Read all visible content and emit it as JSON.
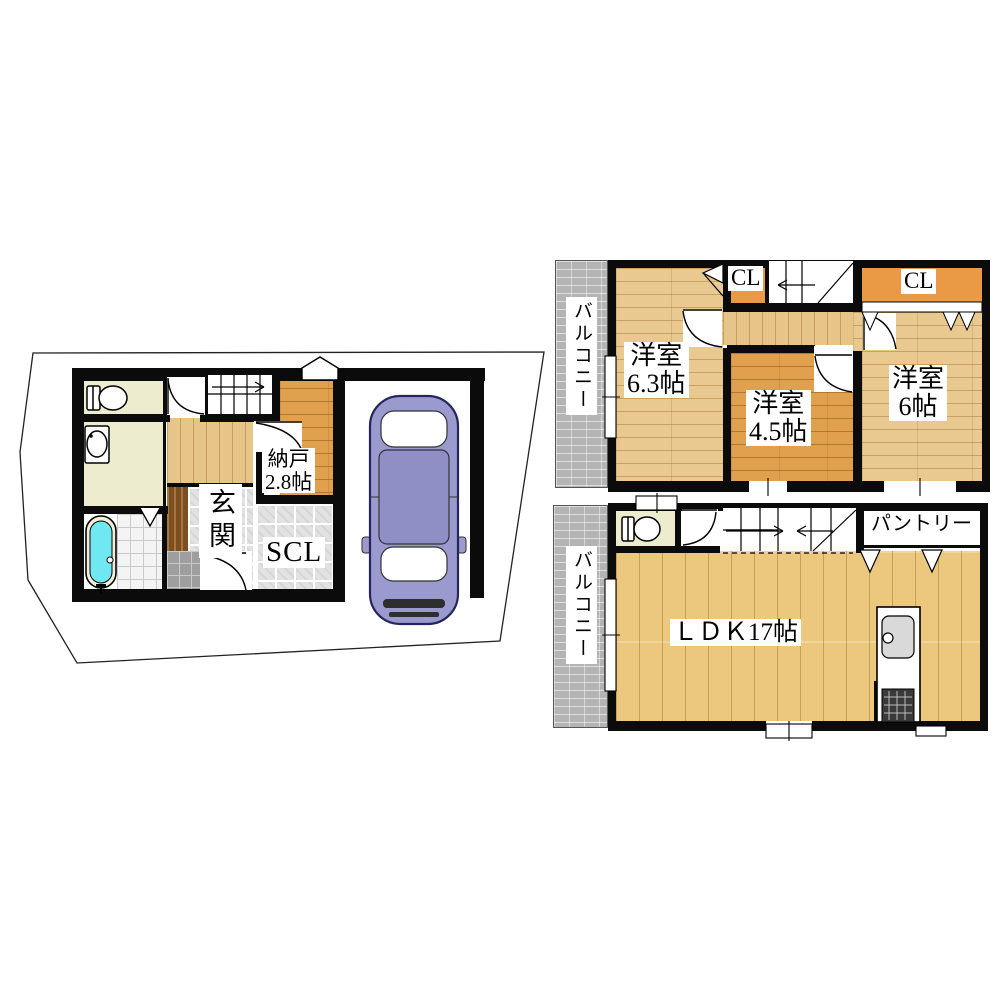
{
  "floors": {
    "floor1": {
      "storage": {
        "name": "納戸",
        "size": "2.8帖"
      },
      "entrance": "玄関",
      "shoe_closet": "SCL"
    },
    "floor_bedrooms": {
      "balcony": "バルコニー",
      "closet_left": "CL",
      "closet_right": "CL",
      "bedroom_63": {
        "name": "洋室",
        "size": "6.3帖"
      },
      "bedroom_45": {
        "name": "洋室",
        "size": "4.5帖"
      },
      "bedroom_6": {
        "name": "洋室",
        "size": "6帖"
      }
    },
    "floor_ldk": {
      "balcony": "バルコニー",
      "ldk": "ＬＤＫ17帖",
      "pantry": "パントリー"
    }
  },
  "colors": {
    "wood_light": "#e9c98f",
    "wood_dark": "#e0a04e",
    "ldk_wood": "#ecc87e",
    "closet_orange": "#ea9a44",
    "utility_cream": "#eeeccf",
    "bathtub_cyan": "#6fe8f2",
    "car_purple": "#9a9ace",
    "balcony_gray": "#b4b4b4",
    "wall_black": "#0b0b0b"
  }
}
